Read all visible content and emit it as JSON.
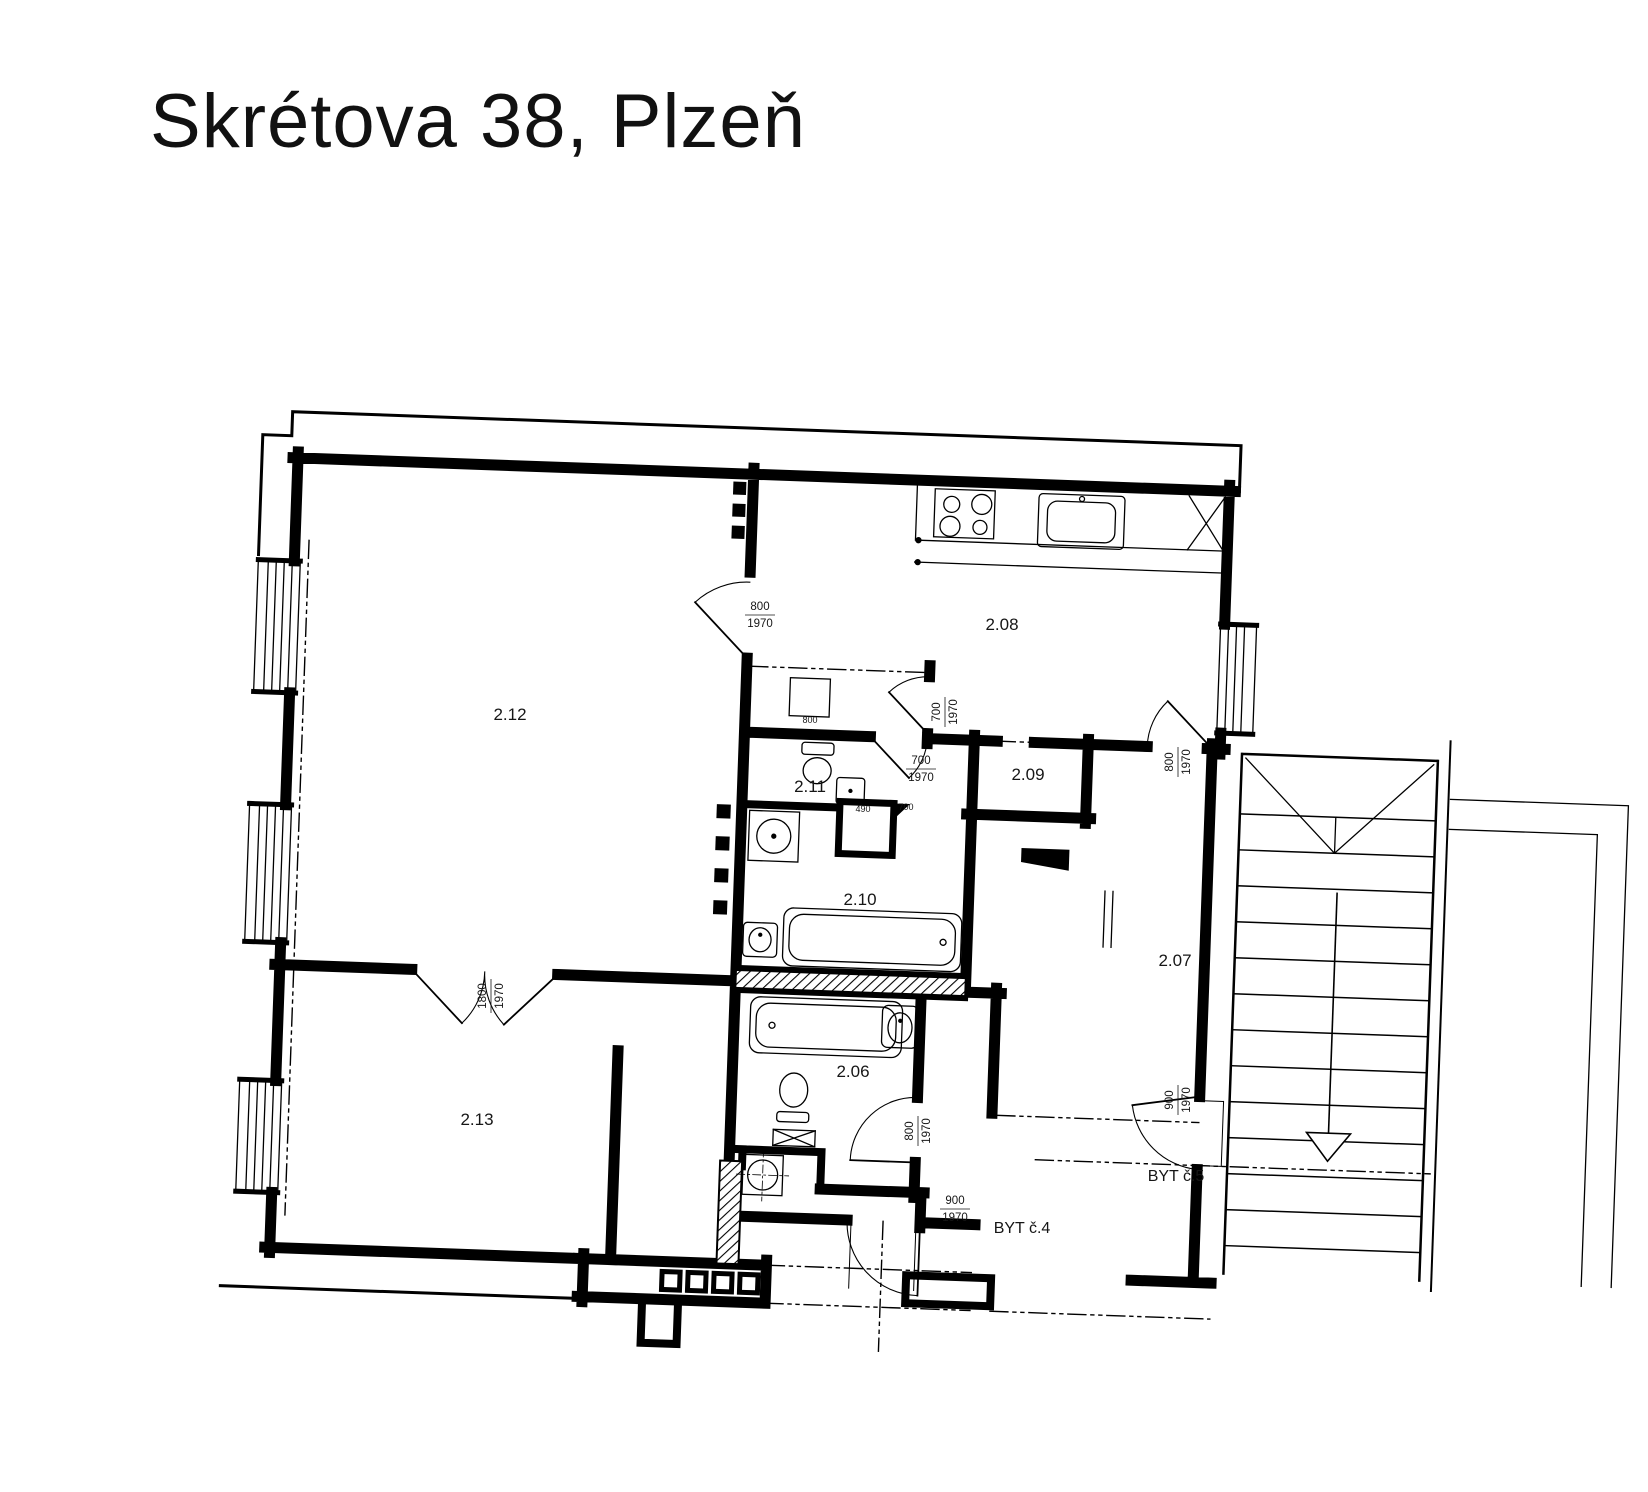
{
  "title": "Skrétova 38, Plzeň",
  "plan": {
    "rooms": [
      {
        "id": "2.06"
      },
      {
        "id": "2.07"
      },
      {
        "id": "2.08"
      },
      {
        "id": "2.09"
      },
      {
        "id": "2.10"
      },
      {
        "id": "2.11"
      },
      {
        "id": "2.12"
      },
      {
        "id": "2.13"
      }
    ],
    "apartments": [
      {
        "label": "BYT č.4"
      },
      {
        "label": "BYT č.5"
      }
    ],
    "doors": [
      {
        "name": "door-2.12-hall",
        "w": "800",
        "h": "1970"
      },
      {
        "name": "door-2.12-2.13",
        "w": "1800",
        "h": "1970"
      },
      {
        "name": "door-kitchen",
        "w": "700",
        "h": "1970"
      },
      {
        "name": "door-lobby",
        "w": "700",
        "h": "1970"
      },
      {
        "name": "door-hall-east",
        "w": "800",
        "h": "1970"
      },
      {
        "name": "door-2.06",
        "w": "800",
        "h": "1970"
      },
      {
        "name": "door-byt5",
        "w": "900",
        "h": "1970"
      },
      {
        "name": "door-byt4",
        "w": "900",
        "h": "1970"
      }
    ],
    "small_dims": [
      {
        "v": "800"
      },
      {
        "v": "490"
      },
      {
        "v": "700"
      }
    ],
    "line_color": "#000000",
    "background": "#ffffff"
  }
}
